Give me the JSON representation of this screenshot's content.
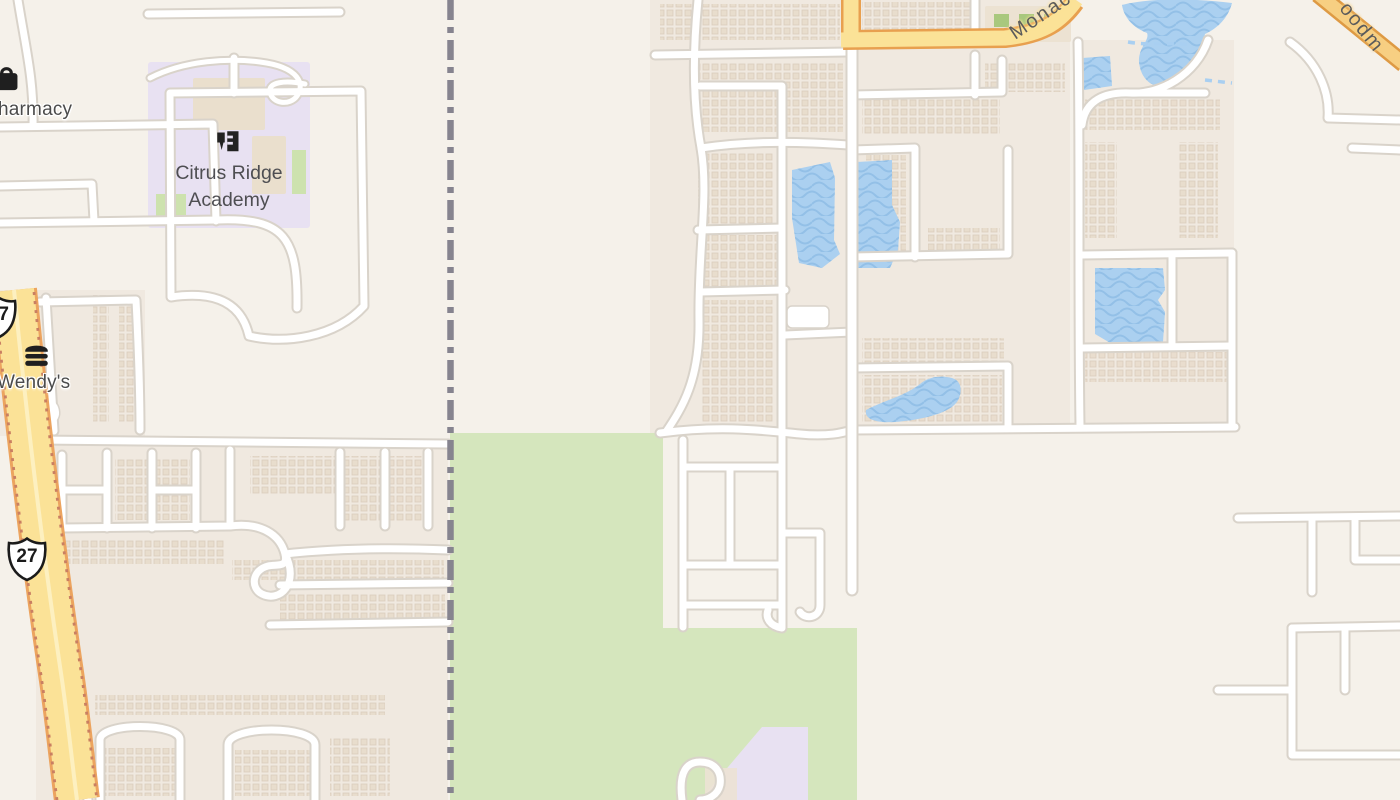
{
  "map": {
    "labels": {
      "pharmacy_partial": "harmacy",
      "wendys": "Wendy's",
      "academy_line1": "Citrus Ridge",
      "academy_line2": "Academy",
      "road_monaco_partial": "Monac",
      "road_goodman_partial": "oodm"
    },
    "shields": {
      "us27": "27",
      "us27_partial_digit": "7"
    },
    "icons": {
      "pharmacy": "shopping-bag-icon",
      "wendys": "burger-icon",
      "academy": "school-icon"
    },
    "colors": {
      "background": "#f5f1ea",
      "residential_block": "#f0e9e0",
      "house_footprint": "#e8dccc",
      "road_fill": "#ffffff",
      "road_casing": "#d9d3ca",
      "highway_fill": "#fbe297",
      "highway_casing": "#eca45f",
      "highway_edge_dots": "#c97f62",
      "secondary_road_fill": "#f7cf82",
      "water": "#abd0f0",
      "water_wave": "#8fbde5",
      "park_green": "#d5e6bd",
      "school_purple": "#e8e1f2",
      "courtyard_green": "#cde2ae",
      "boundary_gray": "#86848f",
      "label_text": "#4b4b4b"
    }
  }
}
